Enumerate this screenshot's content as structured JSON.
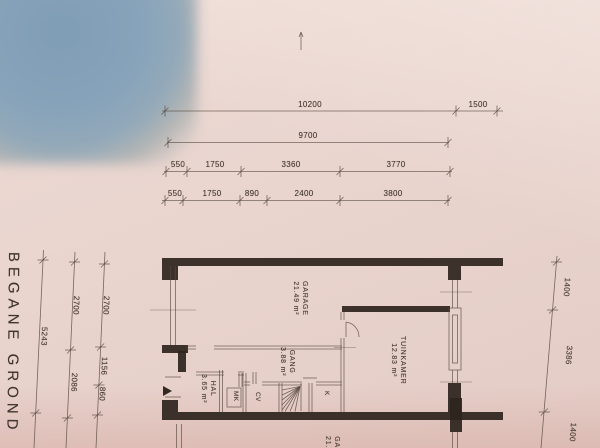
{
  "plan": {
    "title": "BEGANE GROND"
  },
  "colors": {
    "paper": "#e9d4ce",
    "paper_light": "#eedbd5",
    "paper_dark": "#e4ccc5",
    "blue_object": "#87a3ba",
    "ink_thin": "#53463c",
    "ink_wall": "#2e251e",
    "text": "#463a30"
  },
  "dims": {
    "top_rows": [
      [
        "10200",
        "1500"
      ],
      [
        "9700"
      ],
      [
        "550",
        "1750",
        "3360",
        "3770"
      ],
      [
        "550",
        "1750",
        "890",
        "2400",
        "3800"
      ]
    ],
    "left_cols": [
      [
        "5243"
      ],
      [
        "2700",
        "2086"
      ],
      [
        "2700",
        "1156",
        "860"
      ]
    ],
    "right_col": [
      "1400",
      "3386",
      "1400"
    ]
  },
  "rooms": [
    {
      "name": "GARAGE",
      "area": "21.49 m²"
    },
    {
      "name": "HAL",
      "area": "3.65 m²"
    },
    {
      "name": "GANG",
      "area": "3.88 m²"
    },
    {
      "name": "TUINKAMER",
      "area": "12.83 m²"
    }
  ],
  "closets": [
    "MK",
    "CV",
    "K"
  ],
  "partial": {
    "name": "GA",
    "area": "21."
  }
}
